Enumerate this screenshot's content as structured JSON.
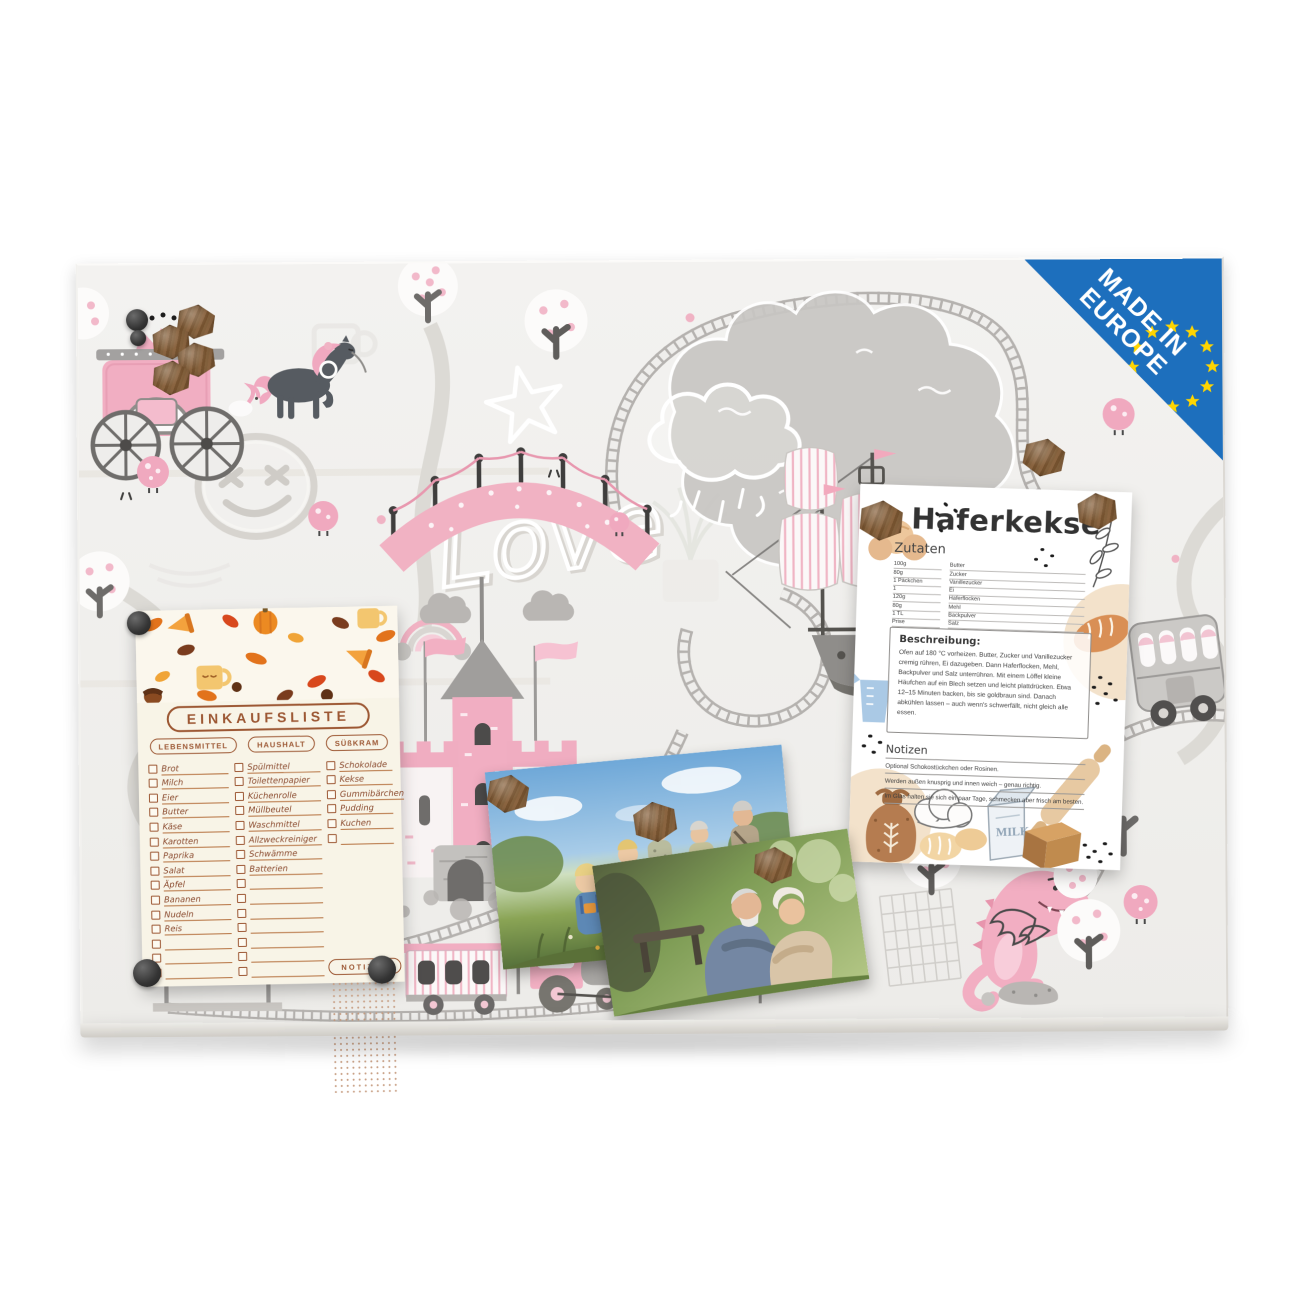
{
  "badge": {
    "line1": "MADE IN",
    "line2": "EUROPE"
  },
  "board": {
    "love_text": "Love"
  },
  "shopping_list": {
    "title": "EINKAUFSLISTE",
    "notes_label": "NOTIZEN",
    "columns": [
      {
        "header": "LEBENSMITTEL",
        "items": [
          "Brot",
          "Milch",
          "Eier",
          "Butter",
          "Käse",
          "Karotten",
          "Paprika",
          "Salat",
          "Äpfel",
          "Bananen",
          "Nudeln",
          "Reis",
          "",
          "",
          ""
        ]
      },
      {
        "header": "HAUSHALT",
        "items": [
          "Spülmittel",
          "Toilettenpapier",
          "Küchenrolle",
          "Müllbeutel",
          "Waschmittel",
          "Allzweckreiniger",
          "Schwämme",
          "Batterien",
          "",
          "",
          "",
          "",
          "",
          "",
          ""
        ]
      },
      {
        "header": "SÜßKRAM",
        "items": [
          "Schokolade",
          "Kekse",
          "Gummibärchen",
          "Pudding",
          "Kuchen",
          ""
        ]
      }
    ]
  },
  "recipe": {
    "title": "Haferkekse",
    "ingredients_label": "Zutaten",
    "ingredients": [
      {
        "amount": "100g",
        "name": "Butter"
      },
      {
        "amount": "80g",
        "name": "Zucker"
      },
      {
        "amount": "1 Päckchen",
        "name": "Vanillezucker"
      },
      {
        "amount": "1",
        "name": "Ei"
      },
      {
        "amount": "120g",
        "name": "Haferflocken"
      },
      {
        "amount": "80g",
        "name": "Mehl"
      },
      {
        "amount": "1 TL",
        "name": "Backpulver"
      },
      {
        "amount": "Prise",
        "name": "Salz"
      }
    ],
    "description_label": "Beschreibung:",
    "description": "Ofen auf 180 °C vorheizen. Butter, Zucker und Vanillezucker cremig rühren, Ei dazugeben. Dann Haferflocken, Mehl, Backpulver und Salz unterrühren. Mit einem Löffel kleine Häufchen auf ein Blech setzen und leicht plattdrücken. Etwa 12–15 Minuten backen, bis sie goldbraun sind. Danach abkühlen lassen – auch wenn's schwerfällt, nicht gleich alle essen.",
    "notes_label": "Notizen",
    "notes": [
      "Optional Schokostückchen oder Rosinen.",
      "Werden außen knusprig und innen weich – genau richtig.",
      "Im Glas halten sie sich ein paar Tage, schmecken aber frisch am besten."
    ],
    "milk_carton_label": "MILK"
  },
  "colors": {
    "badge_blue": "#1d6fbd",
    "star_yellow": "#ffd500",
    "board_pink": "#f2b0c3",
    "board_grey": "#b9b6b3",
    "list_brown": "#9c5733",
    "wood_magnet": "#7a5636"
  }
}
